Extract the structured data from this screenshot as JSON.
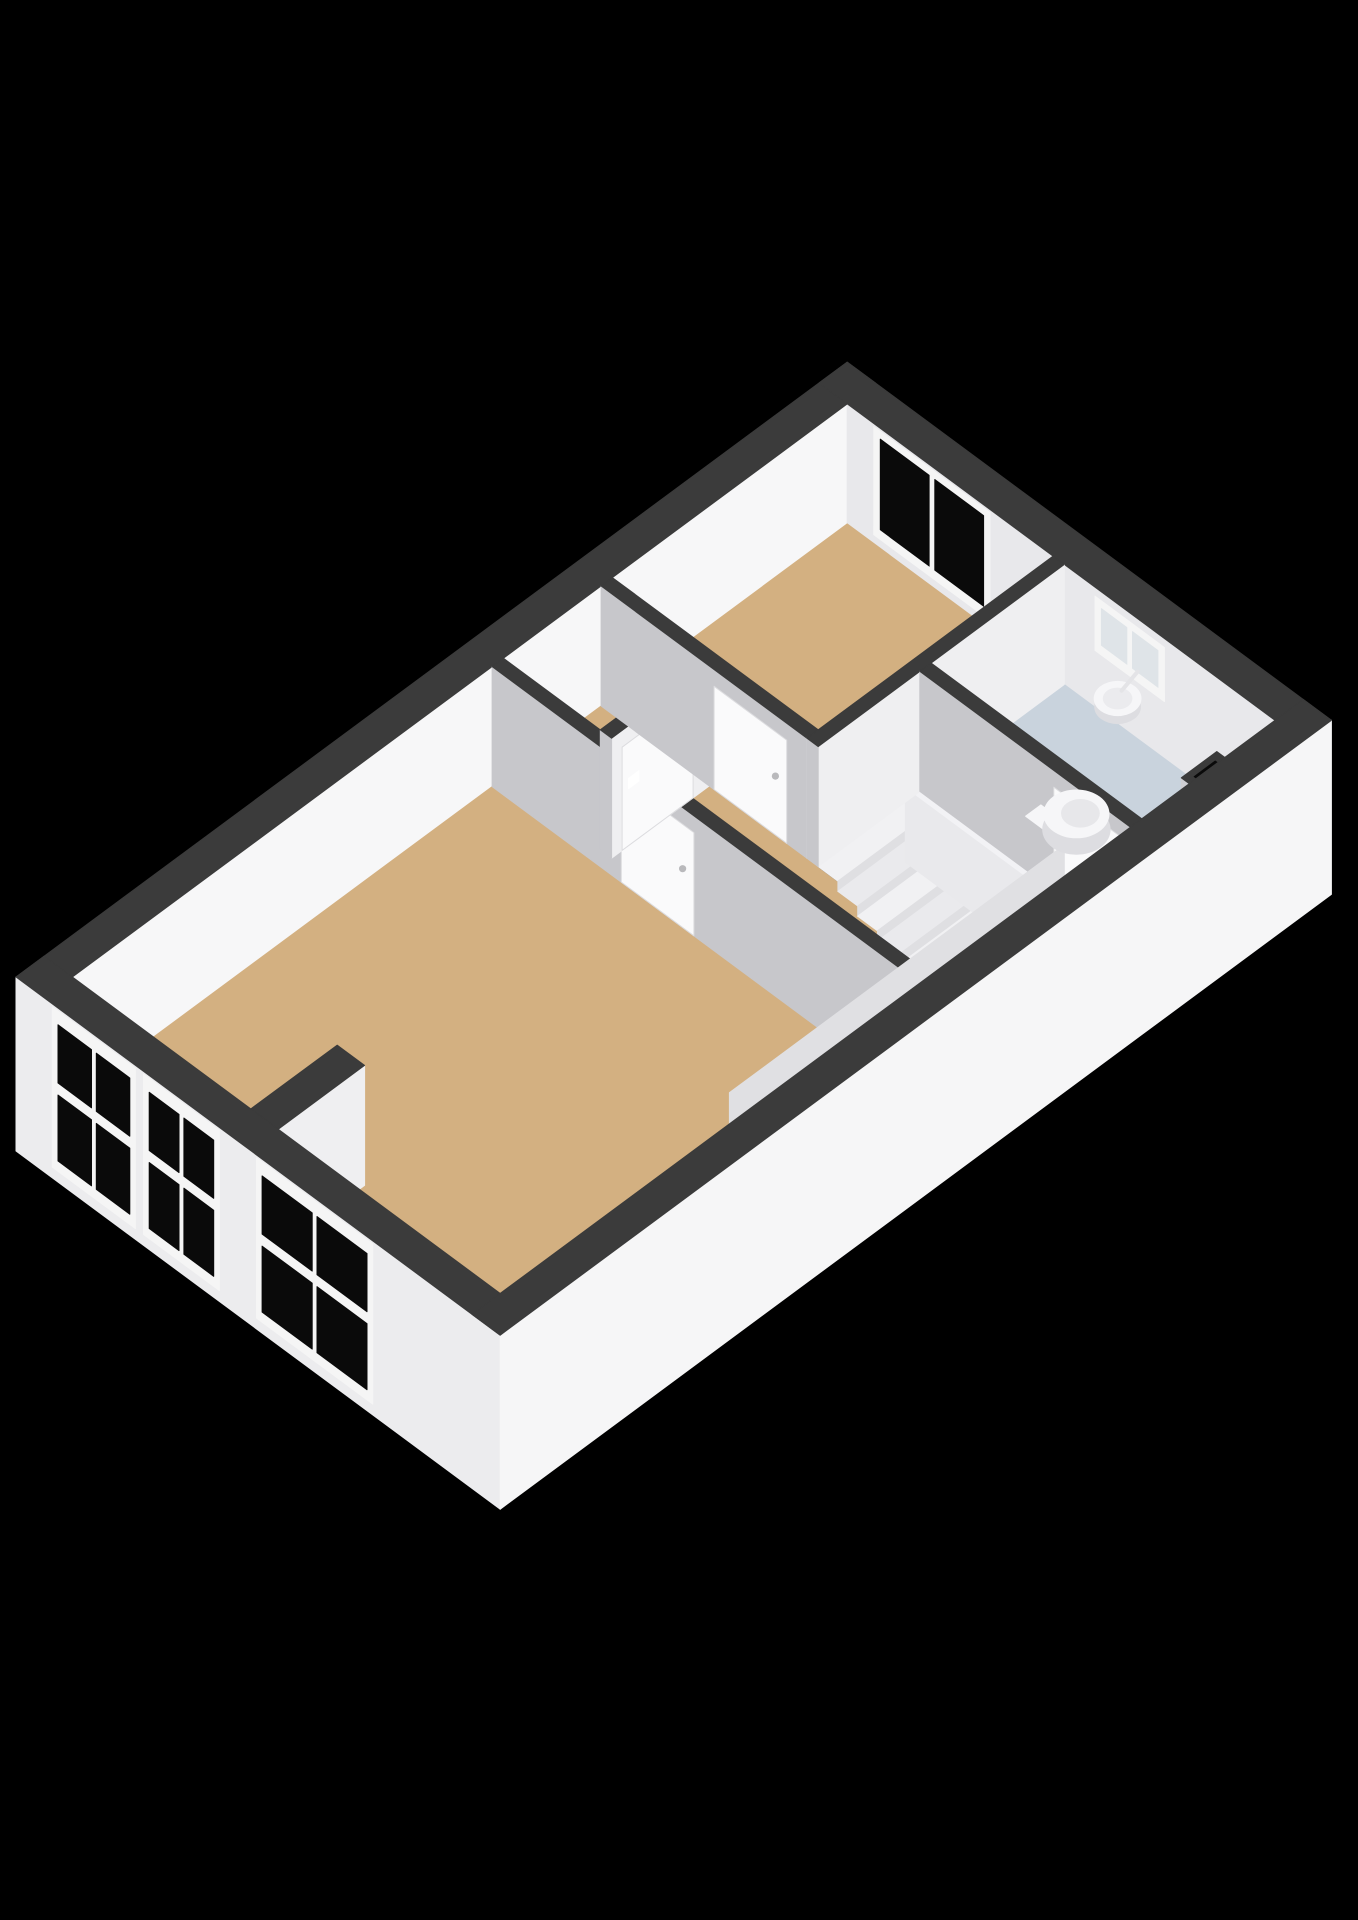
{
  "floorplan": {
    "view": "isometric-3d",
    "background": "#000000",
    "colors": {
      "wall_cap": "#3B3B3B",
      "wall_white": "#F7F7F8",
      "wall_white_ne": "#E8E8EB",
      "wall_gray": "#C7C7CB",
      "wall_bright": "#EFEFF1",
      "outer_sw": "#ECECEE",
      "outer_se": "#F6F6F7",
      "floor_wood": "#D3B081",
      "floor_tile": "#C9D3DD",
      "glass_dark": "#0A0A0A",
      "frame_white": "#F5F5F5",
      "door_white": "#FAFAFB",
      "tread_light": "#F1F1F3",
      "riser": "#DFDFE2",
      "stringer": "#F2F2F5",
      "stair_hole": "#060606",
      "fixture_white": "#F6F6F8",
      "fixture_shade": "#DDDDE1",
      "handle_gray": "#B9B9BC"
    },
    "building": {
      "width": 10.3,
      "depth": 6.0,
      "ext_wall": 0.35,
      "cut_height": 2.0,
      "plinth": 0.9
    },
    "rooms": [
      {
        "id": "living-room",
        "floor": "wood",
        "rects": [
          [
            0.35,
            0.35,
            5.55,
            5.65
          ]
        ]
      },
      {
        "id": "closet",
        "floor": "wood",
        "rects": [
          [
            5.69,
            0.35,
            6.9,
            1.55
          ]
        ]
      },
      {
        "id": "hallway-landing",
        "floor": "wood",
        "rects": [
          [
            5.69,
            1.69,
            6.9,
            5.65
          ],
          [
            6.9,
            5.0,
            8.16,
            5.65
          ]
        ]
      },
      {
        "id": "bedroom",
        "floor": "wood",
        "rects": [
          [
            7.04,
            0.35,
            9.95,
            2.9
          ]
        ]
      },
      {
        "id": "bathroom",
        "floor": "tile",
        "rects": [
          [
            8.3,
            3.04,
            9.95,
            5.65
          ]
        ]
      }
    ],
    "interior_walls": [
      {
        "id": "window-pier-stub-wall",
        "rect": [
          0.35,
          2.56,
          1.42,
          2.9
        ]
      },
      {
        "id": "living-room-hallway-wall",
        "rect": [
          5.55,
          0.35,
          5.69,
          5.65
        ],
        "door": {
          "id": "living-room-door",
          "side": "sw",
          "span": [
            1.95,
            2.85
          ]
        }
      },
      {
        "id": "closet-front-wall",
        "rect": [
          5.69,
          1.55,
          6.9,
          1.69
        ],
        "door": {
          "id": "closet-door",
          "side": "se",
          "span": [
            5.82,
            6.7
          ]
        }
      },
      {
        "id": "bedroom-hallway-wall",
        "rect": [
          6.9,
          0.35,
          7.04,
          2.9
        ],
        "door": {
          "id": "bedroom-door",
          "side": "sw",
          "span": [
            1.75,
            2.65
          ]
        }
      },
      {
        "id": "bedroom-bathroom-wall",
        "rect": [
          6.9,
          2.9,
          9.95,
          3.04
        ]
      },
      {
        "id": "bathroom-hallway-wall",
        "rect": [
          8.16,
          3.04,
          8.3,
          5.65
        ],
        "door": {
          "id": "bathroom-door",
          "side": "sw",
          "span": [
            4.7,
            5.55
          ]
        }
      }
    ],
    "service_chases": [
      {
        "id": "hallway-duct-chase",
        "rect": [
          6.98,
          5.33,
          7.4,
          5.65
        ]
      },
      {
        "id": "bathroom-duct-chase",
        "rect": [
          9.14,
          5.3,
          9.58,
          5.65
        ]
      }
    ],
    "windows": {
      "front_wall": [
        {
          "id": "living-room-window-1",
          "span": [
            0.45,
            1.48
          ]
        },
        {
          "id": "living-room-window-2",
          "span": [
            1.58,
            2.52
          ]
        },
        {
          "id": "living-room-window-3",
          "span": [
            2.98,
            4.42
          ]
        }
      ],
      "rear_wall": [
        {
          "id": "bedroom-window",
          "span": [
            0.68,
            2.12
          ],
          "z": [
            0.15,
            1.95
          ],
          "glass": "dark"
        },
        {
          "id": "bathroom-window",
          "span": [
            3.42,
            4.28
          ],
          "z": [
            0.95,
            1.85
          ],
          "glass": "light"
        }
      ]
    },
    "staircase": {
      "id": "staircase-to-lower-floor",
      "hole": [
        6.9,
        3.04,
        8.16,
        5.0
      ],
      "tread_x": [
        6.9,
        7.98
      ],
      "tread_start_y": 3.04,
      "tread_depth": 0.245,
      "tread_drop": 0.17,
      "tread_count": 6,
      "stringer": [
        7.98,
        3.04,
        8.16,
        4.68
      ],
      "winders": [
        [
          7.4,
          4.52,
          7.98,
          4.76,
          -1.02
        ],
        [
          7.62,
          4.76,
          7.98,
          5.0,
          -1.18
        ]
      ]
    },
    "fixtures": [
      {
        "id": "toilet",
        "room": "bathroom",
        "bowl": [
          8.72,
          4.42
        ],
        "tank": [
          8.33,
          4.18,
          8.52,
          4.66
        ]
      },
      {
        "id": "washbasin",
        "room": "bathroom",
        "center": [
          9.7,
          3.95
        ]
      }
    ],
    "extras": [
      {
        "id": "light-switch",
        "wall": "closet-front-wall",
        "x": [
          5.9,
          6.03
        ],
        "z": [
          0.95,
          1.12
        ]
      }
    ]
  }
}
